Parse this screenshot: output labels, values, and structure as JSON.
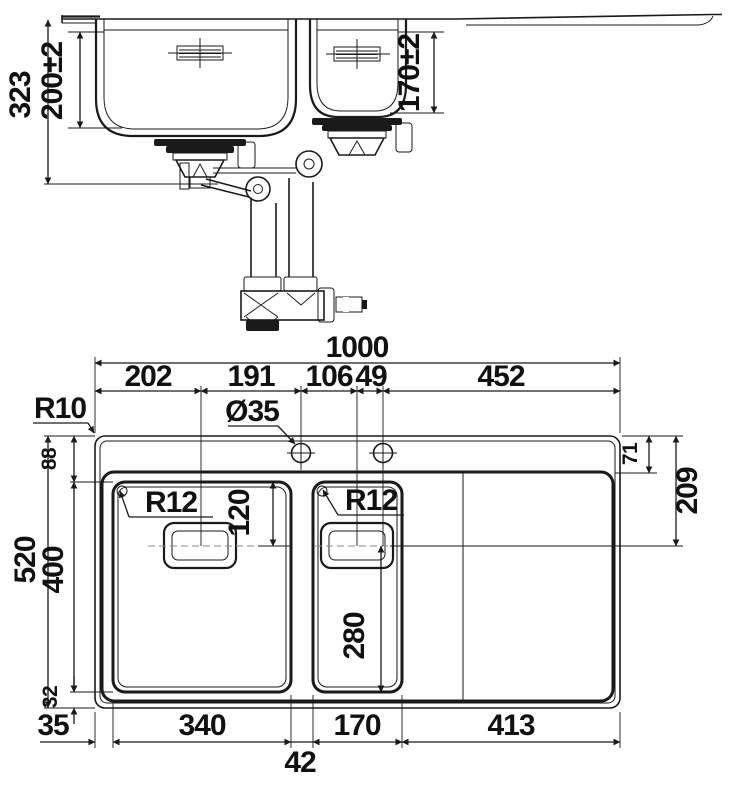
{
  "drawing": {
    "type": "technical-dimension-drawing",
    "subject": "1.5 bowl kitchen sink with drainer, front section and plan view",
    "front_view": {
      "total_depth": "323",
      "main_bowl_depth": "200±2",
      "small_bowl_depth": "170±2"
    },
    "plan_view": {
      "overall_width": "1000",
      "overall_depth": "520",
      "chain_widths": [
        "202",
        "191",
        "106",
        "49",
        "452"
      ],
      "tap_hole_diameter": "Ø35",
      "outer_corner_radius": "R10",
      "main_bowl_corner_radius": "R12",
      "small_bowl_corner_radius": "R12",
      "rim_to_deck": "71",
      "deck_to_drainer_line": "209",
      "rim_to_bowl_top": "88",
      "bowl_length": "400",
      "bowl_to_bottom_edge": "32",
      "left_rim_width": "35",
      "main_bowl_width": "340",
      "divider_width": "42",
      "small_bowl_width": "170",
      "drainer_width": "413",
      "main_overflow_offset": "120",
      "small_overflow_offset": "280"
    }
  }
}
